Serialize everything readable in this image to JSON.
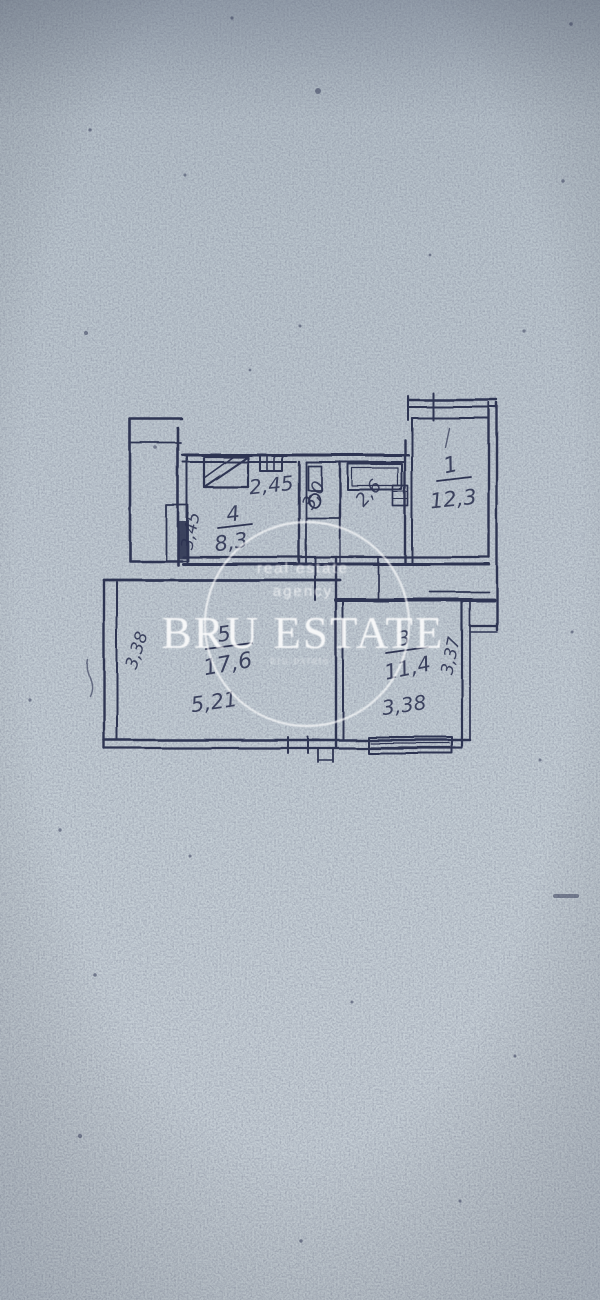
{
  "watermark": {
    "tagline1": "real estate",
    "tagline2": "agency",
    "brand": "BRU ESTATE",
    "subtext": "bru.estate"
  },
  "plan": {
    "type": "hand-drawn apartment floor plan sketch",
    "rooms": [
      {
        "name": "room-1",
        "number": "1",
        "area": "12,3"
      },
      {
        "name": "kitchen",
        "number": "4",
        "area": "8,3"
      },
      {
        "name": "living-room",
        "number": "5",
        "area": "17,6"
      },
      {
        "name": "room-3",
        "number": "3",
        "area": "11,4"
      },
      {
        "name": "bathroom",
        "area": "3,0"
      },
      {
        "name": "wc",
        "area": "2,6"
      }
    ],
    "dimensions": [
      {
        "name": "kitchen-width",
        "value": "2,45"
      },
      {
        "name": "kitchen-depth",
        "value": "3,45"
      },
      {
        "name": "living-width",
        "value": "5,21"
      },
      {
        "name": "living-depth",
        "value": "3,38"
      },
      {
        "name": "room3-width",
        "value": "3,38"
      },
      {
        "name": "room3-depth",
        "value": "3,37"
      }
    ],
    "colors": {
      "ink": "#2e3452",
      "paper": "#c0cad2",
      "watermark": "#ffffff"
    }
  }
}
